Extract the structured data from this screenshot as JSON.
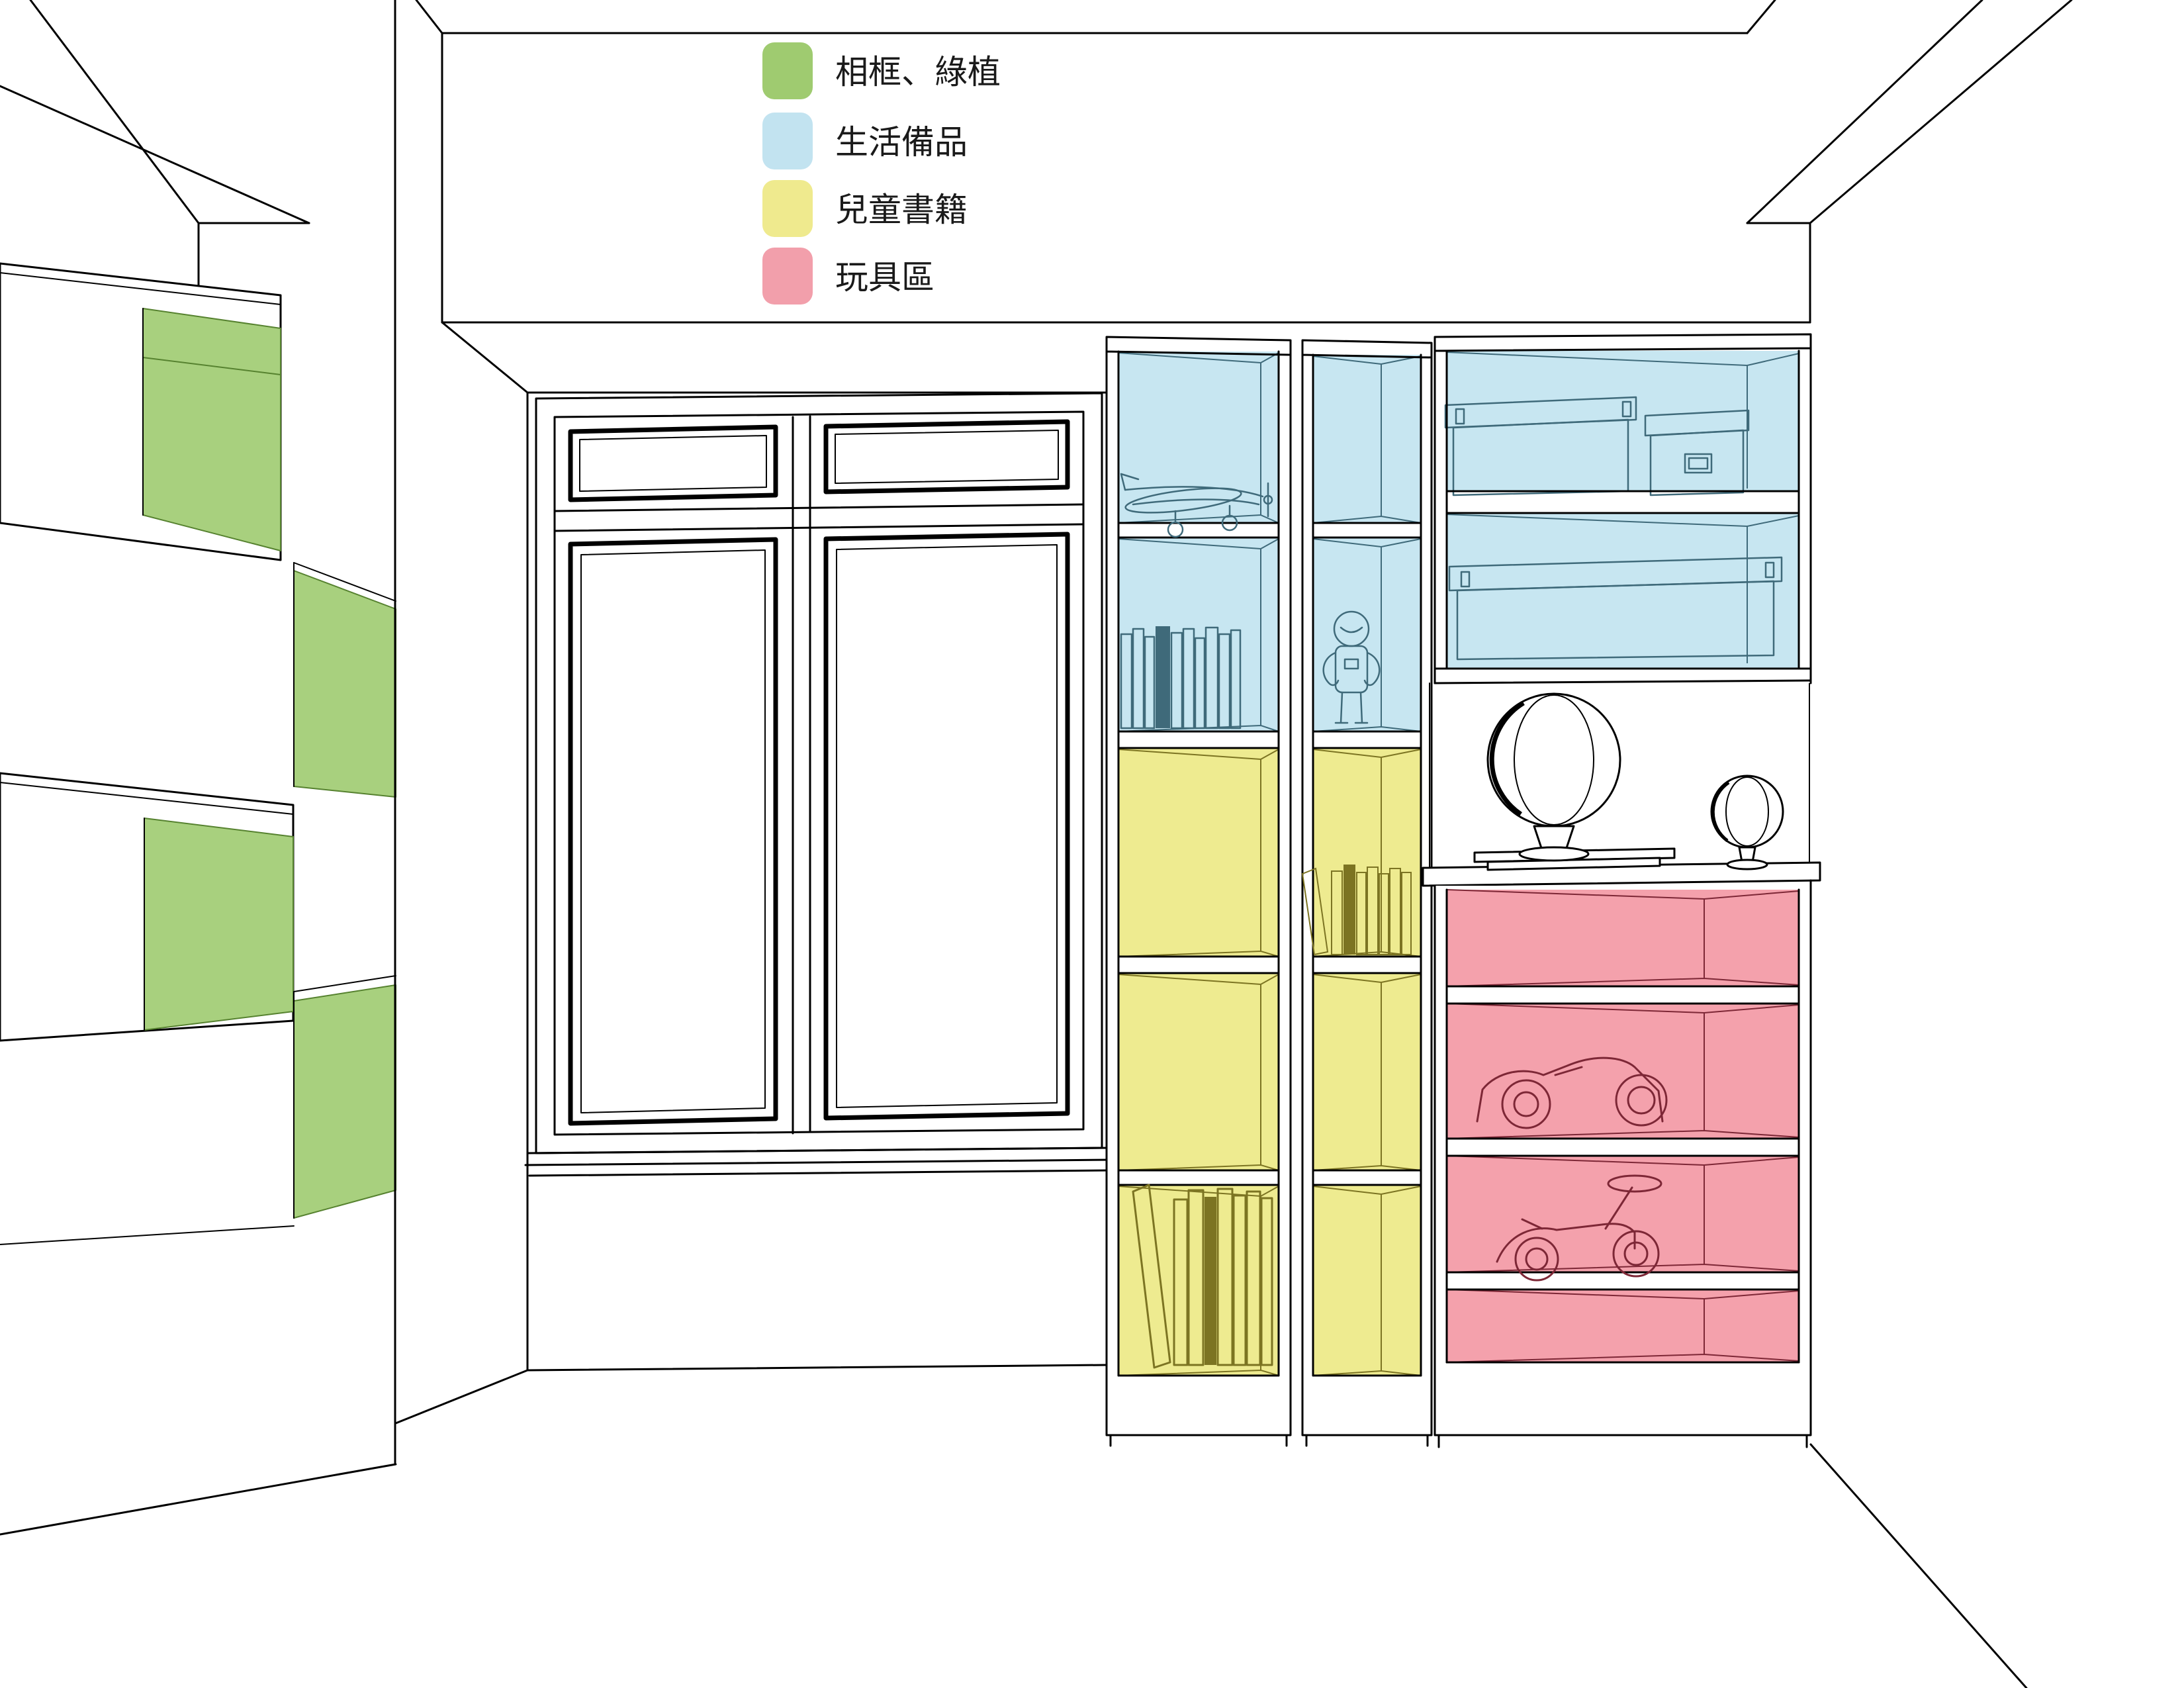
{
  "legend": {
    "items": [
      {
        "id": "frames-plants",
        "label": "相框、綠植",
        "color": "#9fcb70"
      },
      {
        "id": "daily-supplies",
        "label": "生活備品",
        "color": "#c2e3f0"
      },
      {
        "id": "children-books",
        "label": "兒童書籍",
        "color": "#efea8e"
      },
      {
        "id": "toy-area",
        "label": "玩具區",
        "color": "#f29fab"
      }
    ]
  },
  "colors": {
    "green": "#a8d07e",
    "blue": "#c7e6f1",
    "yellow": "#eeeb90",
    "pink": "#f4a1ac",
    "ink": "#000000",
    "teal": "#3f6a7a",
    "olive": "#7c7422",
    "red": "#7d2736",
    "dkgreen": "#56822f",
    "text": "#1a1a1a"
  }
}
